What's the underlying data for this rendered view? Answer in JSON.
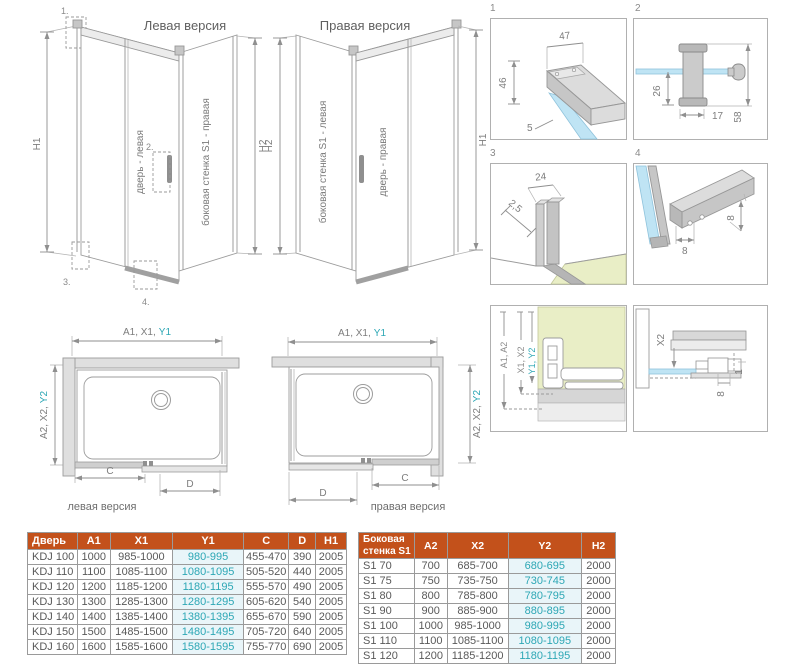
{
  "colors": {
    "header_bg": "#c3511b",
    "highlight_text": "#2da7b5",
    "highlight_bg": "#e9f5f9",
    "glass_blue": "#bfe4f4",
    "wall_green": "#e9eec6"
  },
  "iso_left": {
    "title": "Левая версия",
    "dim_left": "H1",
    "dim_right": "H2",
    "door_label": "дверь - левая",
    "wall_label": "боковая стенка S1 - правая",
    "callout_1": "1.",
    "callout_2": "2.",
    "callout_3": "3.",
    "callout_4": "4."
  },
  "iso_right": {
    "title": "Правая версия",
    "dim_left": "H2",
    "dim_right": "H1",
    "door_label": "дверь - правая",
    "wall_label": "боковая стенка S1 - левая"
  },
  "details": {
    "n1": "1",
    "n2": "2",
    "n3": "3",
    "n4": "4",
    "d1": {
      "width": "47",
      "height": "46",
      "glass": "5"
    },
    "d2": {
      "below": "26",
      "bar": "17",
      "total": "58"
    },
    "d3": {
      "gap": "2,5",
      "width": "24"
    },
    "d4": {
      "w": "8",
      "h": "8"
    },
    "d5": {
      "a": "A1, A2",
      "x": "X1, X2",
      "y": "Y1, Y2"
    },
    "d6": {
      "x2": "X2",
      "e8": "8",
      "e1": "1"
    }
  },
  "plan_left": {
    "top_dim": "A1, X1,",
    "top_dim_hl": "Y1",
    "side_dim": "A2, X2,",
    "side_dim_hl": "Y2",
    "c": "C",
    "d": "D",
    "caption": "левая версия"
  },
  "plan_right": {
    "top_dim": "A1, X1,",
    "top_dim_hl": "Y1",
    "side_dim": "A2, X2,",
    "side_dim_hl": "Y2",
    "c": "C",
    "d": "D",
    "caption": "правая версия"
  },
  "door_table": {
    "headers": [
      "Дверь",
      "A1",
      "X1",
      "Y1",
      "C",
      "D",
      "H1"
    ],
    "highlight_col": 3,
    "rows": [
      [
        "KDJ 100",
        "1000",
        "985-1000",
        "980-995",
        "455-470",
        "390",
        "2005"
      ],
      [
        "KDJ 110",
        "1100",
        "1085-1100",
        "1080-1095",
        "505-520",
        "440",
        "2005"
      ],
      [
        "KDJ 120",
        "1200",
        "1185-1200",
        "1180-1195",
        "555-570",
        "490",
        "2005"
      ],
      [
        "KDJ 130",
        "1300",
        "1285-1300",
        "1280-1295",
        "605-620",
        "540",
        "2005"
      ],
      [
        "KDJ 140",
        "1400",
        "1385-1400",
        "1380-1395",
        "655-670",
        "590",
        "2005"
      ],
      [
        "KDJ 150",
        "1500",
        "1485-1500",
        "1480-1495",
        "705-720",
        "640",
        "2005"
      ],
      [
        "KDJ 160",
        "1600",
        "1585-1600",
        "1580-1595",
        "755-770",
        "690",
        "2005"
      ]
    ]
  },
  "wall_table": {
    "headers": [
      "Боковая стенка S1",
      "A2",
      "X2",
      "Y2",
      "H2"
    ],
    "highlight_col": 3,
    "rows": [
      [
        "S1 70",
        "700",
        "685-700",
        "680-695",
        "2000"
      ],
      [
        "S1 75",
        "750",
        "735-750",
        "730-745",
        "2000"
      ],
      [
        "S1 80",
        "800",
        "785-800",
        "780-795",
        "2000"
      ],
      [
        "S1 90",
        "900",
        "885-900",
        "880-895",
        "2000"
      ],
      [
        "S1 100",
        "1000",
        "985-1000",
        "980-995",
        "2000"
      ],
      [
        "S1 110",
        "1100",
        "1085-1100",
        "1080-1095",
        "2000"
      ],
      [
        "S1 120",
        "1200",
        "1185-1200",
        "1180-1195",
        "2000"
      ]
    ]
  }
}
